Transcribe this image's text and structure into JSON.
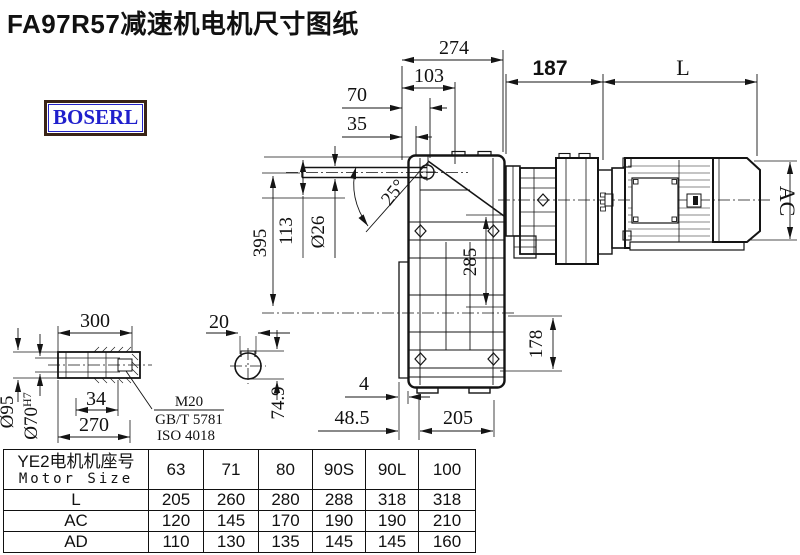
{
  "title": "FA97R57减速机电机尺寸图纸",
  "logo": "BOSERL",
  "dims": {
    "d274": "274",
    "d103": "103",
    "d70": "70",
    "d35": "35",
    "d187": "187",
    "dL": "L",
    "dAC": "AC",
    "d395": "395",
    "d113": "113",
    "d26": "Ø26",
    "angle25": "25°",
    "d285": "285",
    "d178": "178",
    "d4": "4",
    "d48_5": "48.5",
    "d205": "205",
    "d300": "300",
    "d34": "34",
    "d270": "270",
    "d95": "Ø95",
    "d70h": "Ø70",
    "d70h_sup": "H7",
    "m20": "M20",
    "gb": "GB/T 5781",
    "iso": "ISO 4018",
    "d20": "20",
    "d74_9": "74.9"
  },
  "table": {
    "header_cn": "YE2电机机座号",
    "header_en": "Motor Size",
    "sizes": [
      "63",
      "71",
      "80",
      "90S",
      "90L",
      "100"
    ],
    "rows": [
      {
        "label": "L",
        "values": [
          "205",
          "260",
          "280",
          "288",
          "318",
          "318"
        ]
      },
      {
        "label": "AC",
        "values": [
          "120",
          "145",
          "170",
          "190",
          "190",
          "210"
        ]
      },
      {
        "label": "AD",
        "values": [
          "110",
          "130",
          "135",
          "145",
          "145",
          "160"
        ]
      }
    ]
  }
}
